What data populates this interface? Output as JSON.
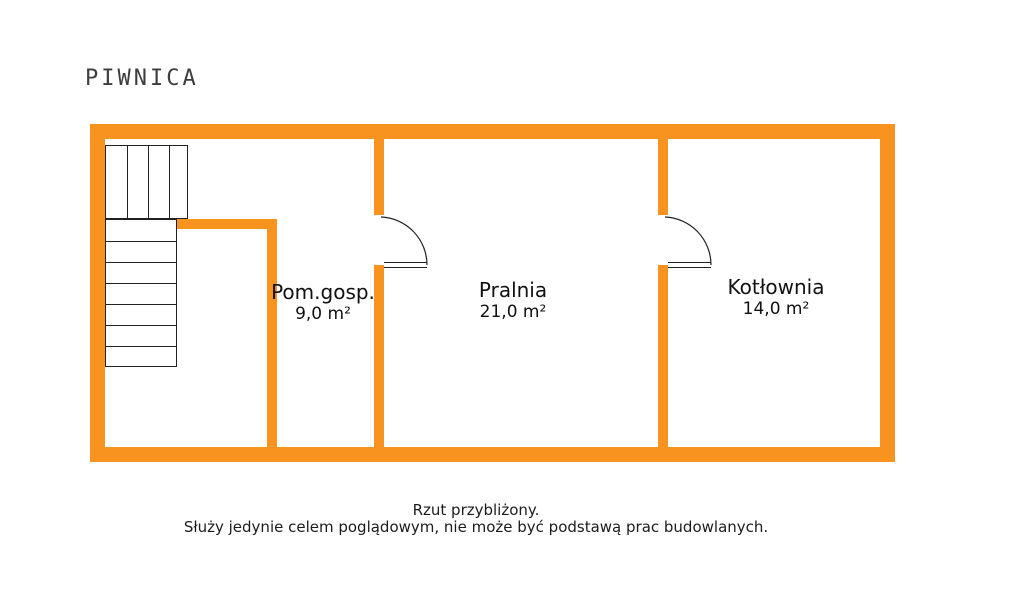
{
  "title": "PIWNICA",
  "floor_plan": {
    "wall_color": "#F7931E",
    "line_color": "#222222",
    "rooms": [
      {
        "id": "pom-gosp",
        "name": "Pom.gosp.",
        "area": "9,0 m²"
      },
      {
        "id": "pralnia",
        "name": "Pralnia",
        "area": "21,0 m²"
      },
      {
        "id": "kotlownia",
        "name": "Kotłownia",
        "area": "14,0 m²"
      }
    ],
    "features": {
      "staircase": "stairs-two-flights",
      "door_count": 2
    }
  },
  "footer": {
    "line1": "Rzut przybliżony.",
    "line2": "Służy jedynie celem poglądowym, nie może być podstawą prac budowlanych."
  }
}
